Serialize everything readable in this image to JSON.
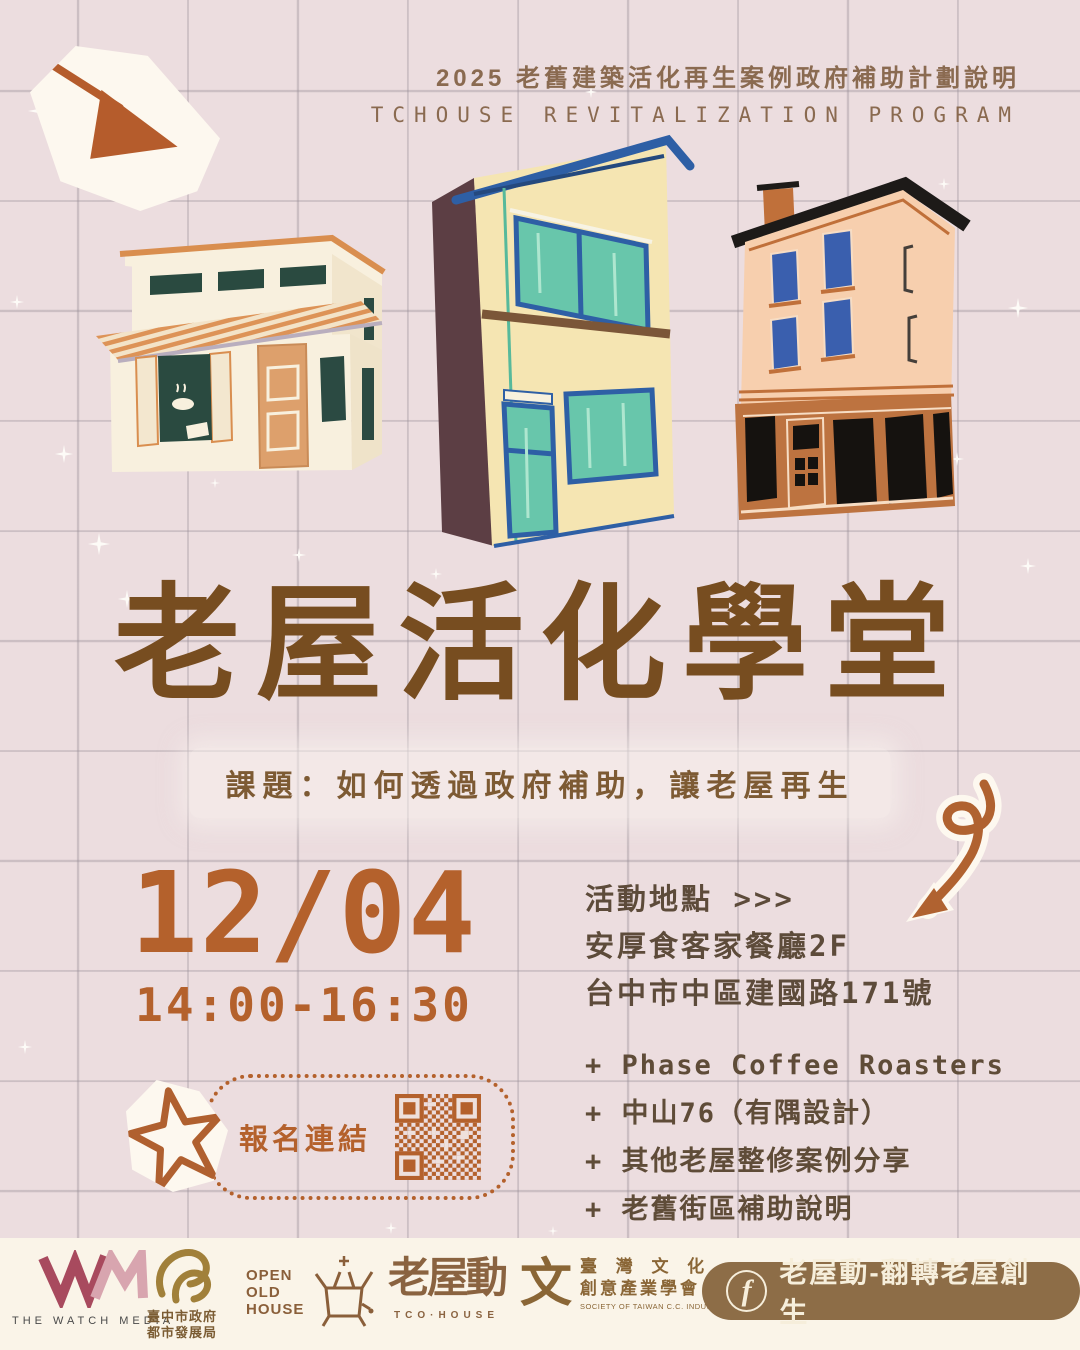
{
  "poster": {
    "program_line1": "2025 老舊建築活化再生案例政府補助計劃說明",
    "program_line2": "TCHOUSE REVITALIZATION PROGRAM",
    "title": "老屋活化學堂",
    "subtitle": "課題：如何透過政府補助，讓老屋再生"
  },
  "event": {
    "date": "12/04",
    "time": "14:00-16:30",
    "location_label": "活動地點 >>>",
    "venue": "安厚食客家餐廳2F",
    "address": "台中市中區建國路171號",
    "agenda": [
      "+ Phase Coffee Roasters",
      "+ 中山76（有隅設計）",
      "+ 其他老屋整修案例分享",
      "+ 老舊街區補助說明"
    ],
    "signup_label": "報名連結"
  },
  "footer": {
    "watch_media_label": "THE WATCH MEDIA",
    "gov_line1": "臺中市政府",
    "gov_line2": "都市發展局",
    "open_old_house_line1": "OPEN",
    "open_old_house_line2": "OLD",
    "open_old_house_line3": "HOUSE",
    "tco_logo": "老屋動",
    "tco_label": "TCO·HOUSE",
    "society_glyph": "文",
    "society_line1": "臺 灣 文 化",
    "society_line2": "創意產業學會",
    "society_line3": "SOCIETY OF TAIWAN C.C. INDUSTRIES",
    "facebook_icon": "f",
    "facebook_label": "老屋動-翻轉老屋創生"
  },
  "colors": {
    "background": "#ecdddf",
    "grid_line": "#978d96",
    "title_brown": "#774d20",
    "accent_orange": "#b4612c",
    "text_brown": "#5d4b3a",
    "teal_window": "#68c6ab",
    "dark_teal_window": "#2a4a40",
    "blue_trim": "#2e5fa5",
    "footer_brown": "#8a5f3a",
    "facebook_pill": "#8d6d47",
    "footer_background": "#faf4e8"
  }
}
